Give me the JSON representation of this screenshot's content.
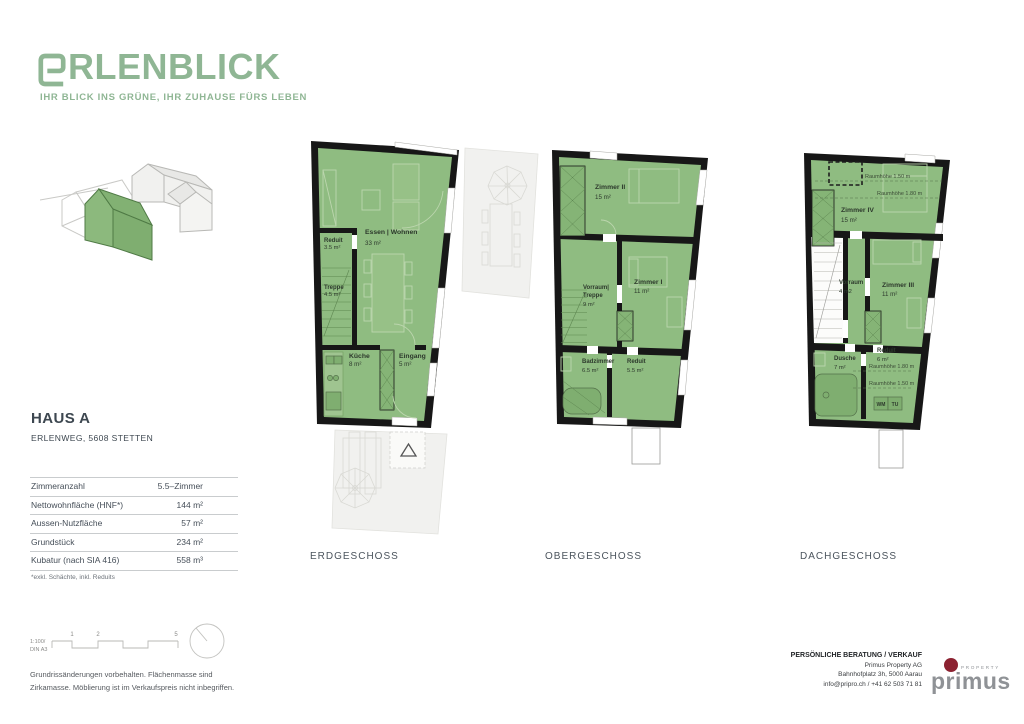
{
  "brand": {
    "logo_text": "RLENBLICK",
    "tagline": "IHR BLICK INS GRÜNE, IHR ZUHAUSE FÜRS LEBEN",
    "green": "#8FB694"
  },
  "property": {
    "title": "HAUS A",
    "address": "ERLENWEG, 5608 STETTEN",
    "specs": [
      {
        "label": "Zimmeranzahl",
        "value": "5.5–Zimmer"
      },
      {
        "label": "Nettowohnfläche (HNF*)",
        "value": "144 m²"
      },
      {
        "label": "Aussen-Nutzfläche",
        "value": "57 m²"
      },
      {
        "label": "Grundstück",
        "value": "234 m²"
      },
      {
        "label": "Kubatur (nach SIA 416)",
        "value": "558 m³"
      }
    ],
    "footnote": "*exkl. Schächte, inkl. Reduits"
  },
  "floors": [
    {
      "label": "ERDGESCHOSS",
      "rooms": [
        {
          "name": "Reduit",
          "area": "3.5 m²"
        },
        {
          "name": "Treppe",
          "area": "4.5 m²"
        },
        {
          "name": "Essen | Wohnen",
          "area": "33 m²"
        },
        {
          "name": "Küche",
          "area": "8 m²"
        },
        {
          "name": "Eingang",
          "area": "5 m²"
        }
      ]
    },
    {
      "label": "OBERGESCHOSS",
      "rooms": [
        {
          "name": "Zimmer II",
          "area": "15 m²"
        },
        {
          "name": "Vorraum|",
          "name2": "Treppe",
          "area": "9 m²"
        },
        {
          "name": "Zimmer I",
          "area": "11 m²"
        },
        {
          "name": "Badzimmer",
          "area": "6.5 m²"
        },
        {
          "name": "Reduit",
          "area": "5.5 m²"
        }
      ]
    },
    {
      "label": "DACHGESCHOSS",
      "rooms": [
        {
          "name": "Zimmer IV",
          "area": "15 m²"
        },
        {
          "name": "Vorraum",
          "area": "4 m2"
        },
        {
          "name": "Zimmer III",
          "area": "11 m²"
        },
        {
          "name": "Dusche",
          "area": "7 m²"
        },
        {
          "name": "Reduit",
          "area": "6 m²"
        }
      ],
      "annotations": {
        "a1": "Raumhöhe 1.50 m",
        "a2": "Raumhöhe 1.80 m",
        "a3": "Raumhöhe 1.80 m",
        "a4": "Raumhöhe 1.50 m"
      },
      "appliances": {
        "wm": "WM",
        "tu": "TU"
      }
    }
  ],
  "scale": {
    "ratio": "1:100/",
    "sheet": "DIN A3",
    "m1": "1",
    "m2": "2",
    "m5": "5"
  },
  "disclaimer": {
    "line1": "Grundrissänderungen vorbehalten. Flächenmasse sind",
    "line2": "Zirkamasse. Möblierung ist im Verkaufspreis nicht inbegriffen."
  },
  "contact": {
    "header": "PERSÖNLICHE BERATUNG / VERKAUF",
    "company": "Primus Property AG",
    "address": "Bahnhofplatz 3h, 5000 Aarau",
    "phone": "info@pripro.ch / +41 62 503 71 81"
  },
  "vendor": {
    "wordmark": "primus",
    "sub": "PROPERTY",
    "red": "#8C2231"
  },
  "colors": {
    "plan_green": "#8FBC81",
    "wall": "#171717",
    "terrace": "#F1F1EF"
  }
}
